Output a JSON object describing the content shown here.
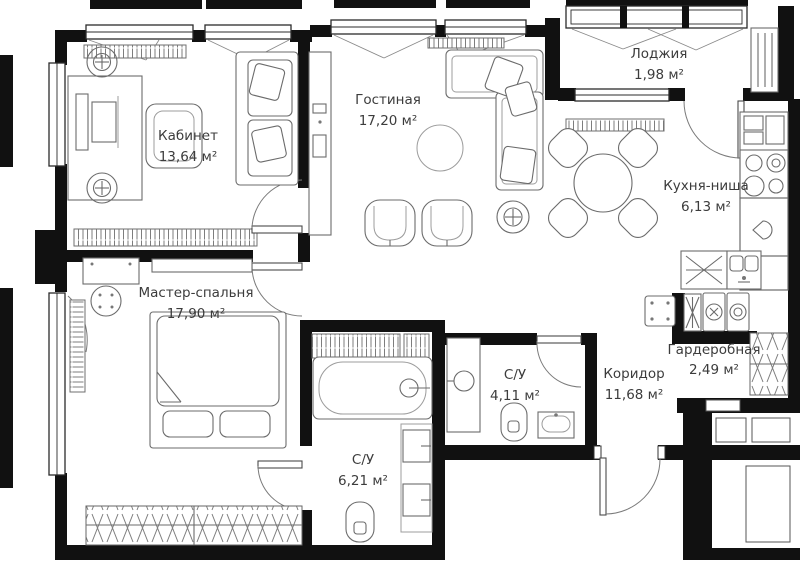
{
  "plan": {
    "title": "apartment-floor-plan",
    "units": "м²"
  },
  "rooms": [
    {
      "id": "office",
      "name": "Кабинет",
      "area": "13,64 м²"
    },
    {
      "id": "living",
      "name": "Гостиная",
      "area": "17,20 м²"
    },
    {
      "id": "loggia",
      "name": "Лоджия",
      "area": "1,98 м²"
    },
    {
      "id": "kitchen",
      "name": "Кухня-ниша",
      "area": "6,13 м²"
    },
    {
      "id": "master",
      "name": "Мастер-спальня",
      "area": "17,90 м²"
    },
    {
      "id": "bath-small",
      "name": "С/У",
      "area": "4,11 м²"
    },
    {
      "id": "bath-large",
      "name": "С/У",
      "area": "6,21 м²"
    },
    {
      "id": "corridor",
      "name": "Коридор",
      "area": "11,68 м²"
    },
    {
      "id": "wardrobe",
      "name": "Гардеробная",
      "area": "2,49 м²"
    }
  ],
  "colors": {
    "wall": "#111111",
    "line": "#6b6b6b",
    "line-light": "#9c9c9c",
    "text": "#3c3c3c",
    "bg": "#ffffff",
    "hatch": "#808080"
  }
}
